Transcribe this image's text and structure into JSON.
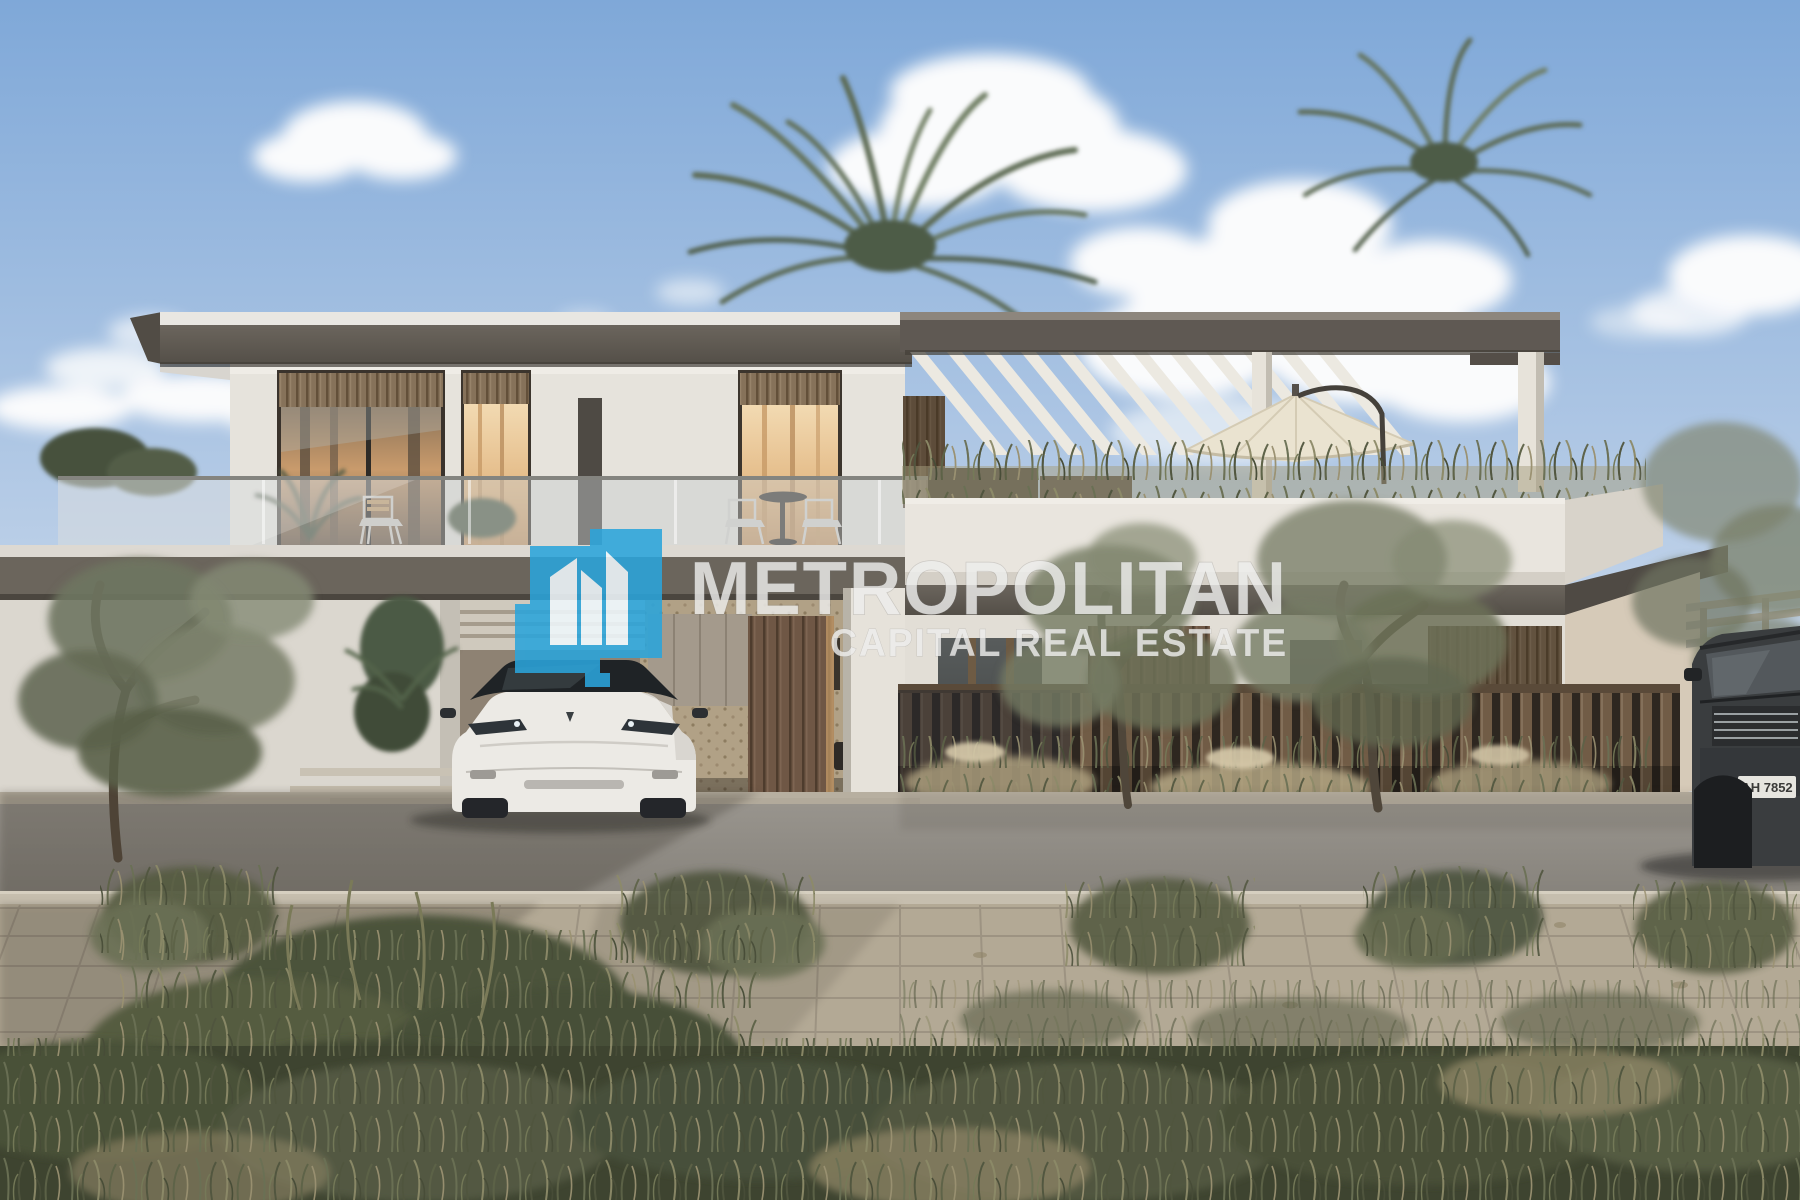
{
  "meta": {
    "kind": "architectural-rendering",
    "subject": "Modern two-storey white villa with rooftop pergola terrace, driveway car and landscaped street frontage at dusk-lit daytime"
  },
  "watermark": {
    "brand_name": "METROPOLITAN",
    "brand_subtitle": "CAPITAL REAL ESTATE",
    "logo_icon": "metropolitan-buildings-logo",
    "logo_color": "#2BA4DB",
    "logo_building_color": "#FFFFFF",
    "text_color": "#EDEDEC"
  },
  "vehicles": {
    "driveway_car": "white-suv",
    "street_car": "dark-suv",
    "suv_plate_text": "AH 7852"
  },
  "palette": {
    "sky_top": "#7FA8D8",
    "sky_horizon": "#CCDAEC",
    "cloud": "#FAFBFC",
    "wall_white": "#E6E3DC",
    "roof_fascia": "#5F5A52",
    "wood_slat": "#8A755A",
    "pergola_slat": "#ECE9E1",
    "umbrella": "#EAE3D0",
    "fence_wood": "#6F5B46",
    "road": "#908C85",
    "paver": "#B3A995",
    "shrub_green": "#565B42",
    "shrub_dry": "#9A9172",
    "window_glow": "#E0B583",
    "car_white": "#ECEAE5",
    "suv_grey": "#3A3D3F"
  }
}
